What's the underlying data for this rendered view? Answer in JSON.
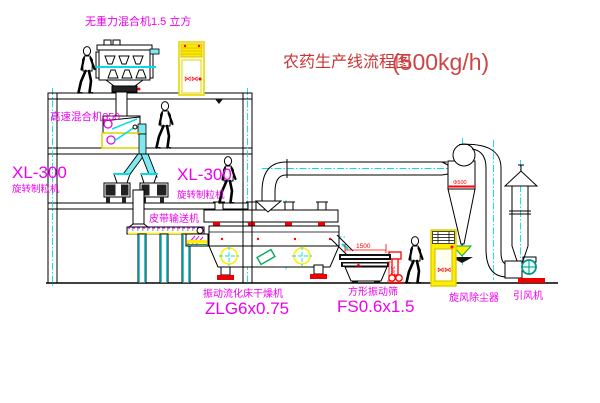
{
  "title": {
    "name": "农药生产线流程图",
    "capacity": "(500kg/h)"
  },
  "annotations": {
    "zero_gravity_mixer": "无重力混合机1.5 立方",
    "high_speed_mixer": "高速混合机350",
    "left_granulator": {
      "model": "XL-300",
      "name": "旋转制粒机"
    },
    "right_granulator": {
      "model": "XL-300",
      "name": "旋转制粒机"
    },
    "belt_conveyor": "皮带输送机",
    "dryer": {
      "name": "振动流化床干燥机",
      "model": "ZLG6x0.75"
    },
    "sieve": {
      "name": "方形振动筛",
      "model": "FS0.6x1.5",
      "dim_length": "1500",
      "dim_height": "340"
    },
    "cyclone": {
      "name": "旋风除尘器",
      "dim": "Φ500"
    },
    "fan": "引风机",
    "cabinet_symbol": "⋈⋈"
  },
  "colors": {
    "line": "#000000",
    "centerline_aqua": "#00dfe8",
    "label_magenta": "#ee00ee",
    "title_red": "#cc3333",
    "detail_red": "#ff0000",
    "equipment_yellow": "#ffee00",
    "detail_green": "#00aa55"
  }
}
